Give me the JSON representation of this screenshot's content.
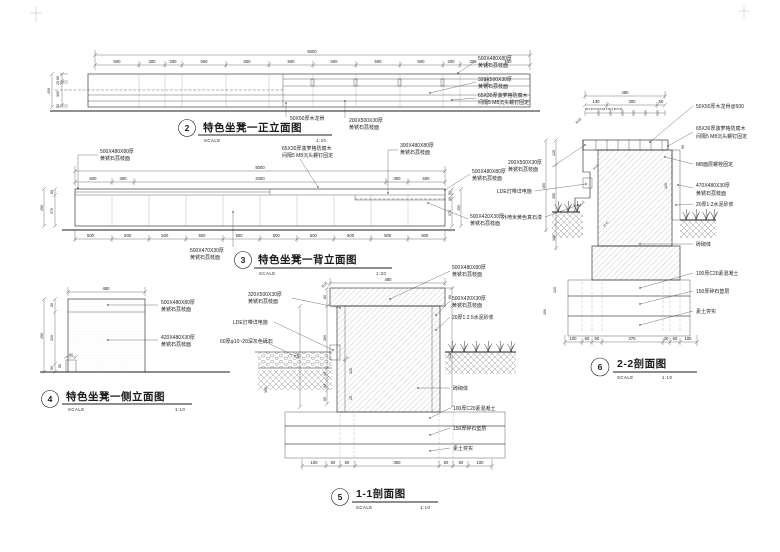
{
  "sc": "SCALE",
  "f": {
    "title": "特色坐凳一正立面图",
    "num": "2",
    "scale_v": "1:20",
    "total": "5000",
    "row": [
      "500",
      "300",
      "200",
      "500",
      "500",
      "500",
      "500",
      "500",
      "500",
      "200",
      "300",
      "500"
    ],
    "v": [
      "80",
      "20",
      "300",
      "50"
    ],
    "vt": "450",
    "lab": [
      [
        "500X480X80厚",
        "黄锈石荔枝面"
      ],
      [
        "320X500X30厚",
        "黄锈石荔枝面"
      ],
      [
        "65X30厚菠萝格防腐木",
        "间隔5 M8沉头螺钉固定"
      ],
      [
        "50X50厚木龙骨"
      ],
      [
        "200X500X30厚",
        "黄锈石荔枝面"
      ]
    ]
  },
  "b": {
    "title": "特色坐凳一背立面图",
    "num": "3",
    "scale_v": "1:20",
    "total": "5000",
    "row": [
      "500",
      "300",
      "3400",
      "300",
      "500"
    ],
    "row500": "500 500 500 500 500 500 500 500 500 500",
    "v": [
      "80",
      "370"
    ],
    "vt": "450",
    "vr": [
      "50",
      "30",
      "370"
    ],
    "vrt": "450",
    "lab": [
      [
        "500X480X80厚",
        "黄锈石荔枝面"
      ],
      [
        "65X30厚菠萝格防腐木",
        "间隔5 M8沉头螺钉固定"
      ],
      [
        "300X480X80厚",
        "黄锈石荔枝面"
      ],
      [
        "500X480X80厚",
        "黄锈石荔枝面"
      ],
      [
        "500X420X30厚",
        "黄锈石荔枝面"
      ],
      [
        "500X470X30厚",
        "黄锈石荔枝面"
      ]
    ]
  },
  "s": {
    "title": "特色坐凳一侧立面图",
    "num": "4",
    "scale_v": "1:10",
    "top": "480",
    "v": [
      "80",
      "320",
      "50"
    ],
    "vt": "450",
    "step": [
      "50",
      "50"
    ],
    "lab": [
      [
        "500X480X80厚",
        "黄锈石荔枝面"
      ],
      [
        "420X480X30厚",
        "黄锈石荔枝面"
      ]
    ]
  },
  "x1": {
    "title": "1-1剖面图",
    "num": "5",
    "scale_v": "1:10",
    "top": "480",
    "r15": "R15",
    "vr": [
      "80",
      "420"
    ],
    "vl": [
      "420",
      "80",
      "260",
      "40",
      "50",
      "60",
      "120",
      "20",
      "300"
    ],
    "small": "20 45",
    "row": [
      "100",
      "60",
      "60",
      "350",
      "60",
      "60",
      "100"
    ],
    "labL": [
      [
        "320X500X30厚",
        "黄锈石荔枝面"
      ],
      [
        "LDE灯带详电施"
      ],
      [
        "60厚φ10~20深灰色砾石"
      ]
    ],
    "labR": [
      [
        "500X480X80厚",
        "黄锈石荔枝面"
      ],
      [
        "500X420X30厚",
        "黄锈石荔枝面"
      ],
      [
        "20厚1:2.5水泥砂浆"
      ],
      [
        "砖砌体"
      ],
      [
        "100厚C20素混凝土"
      ],
      [
        "150厚碎石垫层"
      ],
      [
        "素土夯实"
      ]
    ]
  },
  "x2": {
    "title": "2-2剖面图",
    "num": "6",
    "scale_v": "1:10",
    "top": "480",
    "r15": "R15",
    "row1": [
      "130",
      "300",
      "50"
    ],
    "fine": "80 5 65 5 65 5 65 5 65 5 65 5 45",
    "vl": [
      "125",
      "355",
      "160",
      "120",
      "300"
    ],
    "vlt": "450",
    "vr": [
      "420",
      "50"
    ],
    "small": [
      "30 50",
      "50 40",
      "20 45"
    ],
    "row": [
      "100",
      "60",
      "60",
      "370",
      "40",
      "60",
      "100"
    ],
    "labL": [
      [
        "200X500X30厚",
        "黄锈石荔枝面"
      ],
      [
        "LDE灯带详电施"
      ],
      [
        "外喷米黄色真石漆"
      ]
    ],
    "labR": [
      [
        "50X50厚木龙骨@500"
      ],
      [
        "65X30厚菠萝格防腐木",
        "间隔5 M8沉头螺钉固定"
      ],
      [
        "M8面层螺栓固定"
      ],
      [
        "470X480X30厚",
        "黄锈石荔枝面"
      ],
      [
        "20厚1:2水泥砂浆"
      ],
      [
        "砖砌体"
      ],
      [
        "100厚C20素混凝土"
      ],
      [
        "150厚碎石垫层"
      ],
      [
        "素土夯实"
      ]
    ]
  }
}
